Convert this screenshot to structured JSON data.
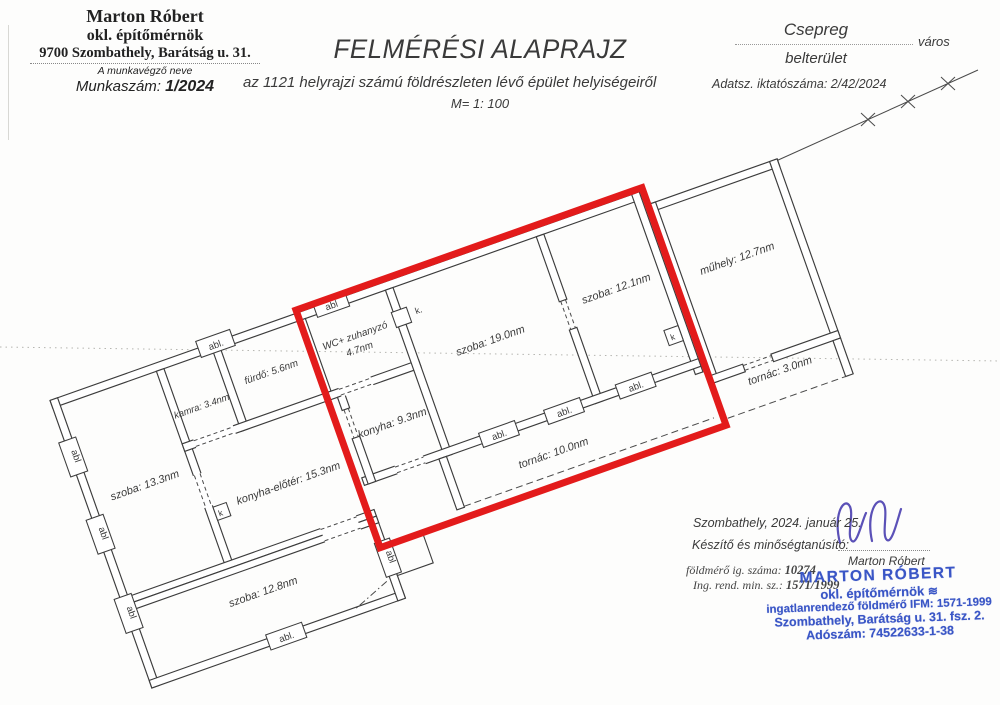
{
  "surveyor_block": {
    "name": "Marton Róbert",
    "title": "okl. építőmérnök",
    "address": "9700 Szombathely, Barátság u. 31.",
    "caption": "A munkavégző neve",
    "work_number_label": "Munkaszám:",
    "work_number": "1/2024"
  },
  "title_block": {
    "title": "FELMÉRÉSI ALAPRAJZ",
    "subtitle": "az 1121 helyrajzi számú földrészleten lévő épület helyiségeiről",
    "data_reg": "Adatsz. iktatószáma: 2/42/2024",
    "scale": "M= 1: 100"
  },
  "location_block": {
    "city": "Csepreg",
    "city_type": "város",
    "area": "belterület"
  },
  "plan": {
    "rooms": [
      {
        "id": "szoba-13-3",
        "label": "szoba: 13.3nm"
      },
      {
        "id": "kamra",
        "label": "kamra: 3.4nm"
      },
      {
        "id": "furdo",
        "label": "fürdő: 5.6nm"
      },
      {
        "id": "wc-zuhanyzo",
        "label": "WC+ zuhanyzó",
        "label2": "4.7nm"
      },
      {
        "id": "szoba-19-0",
        "label": "szoba: 19.0nm"
      },
      {
        "id": "szoba-12-1",
        "label": "szoba: 12.1nm"
      },
      {
        "id": "konyha",
        "label": "konyha: 9.3nm"
      },
      {
        "id": "konyha-eloter",
        "label": "konyha-előtér: 15.3nm"
      },
      {
        "id": "tornac-10-0",
        "label": "tornác: 10.0nm"
      },
      {
        "id": "szoba-12-8",
        "label": "szoba: 12.8nm"
      },
      {
        "id": "muhely",
        "label": "műhely: 12.7nm"
      },
      {
        "id": "tornac-3-0",
        "label": "tornác: 3.0nm"
      }
    ],
    "markers": {
      "window": "abl.",
      "window_plain": "abl",
      "chimney": "k.",
      "chimney_plain": "k"
    }
  },
  "certification": {
    "place_date": "Szombathely, 2024. január 25.",
    "certifier_label": "Készítő és minőségtanúsító:",
    "signatory": "Marton Róbert",
    "surveyor_id_label": "földmérő ig. száma:",
    "surveyor_id": "10274",
    "reg_label": "Ing. rend. min. sz.:",
    "reg_number": "1571/1999"
  },
  "stamp": {
    "name": "MARTON RÓBERT",
    "title": "okl. építőmérnök",
    "line3": "ingatlanrendező földmérő IFM: 1571-1999",
    "line4": "Szombathely, Barátság u. 31. fsz. 2.",
    "line5": "Adószám: 74522633-1-38"
  },
  "colors": {
    "outline_red": "#e31b1b",
    "stamp_blue": "#3a56c6",
    "signature_ink": "#4a3fb0",
    "wall_line": "#3c3c3c"
  }
}
